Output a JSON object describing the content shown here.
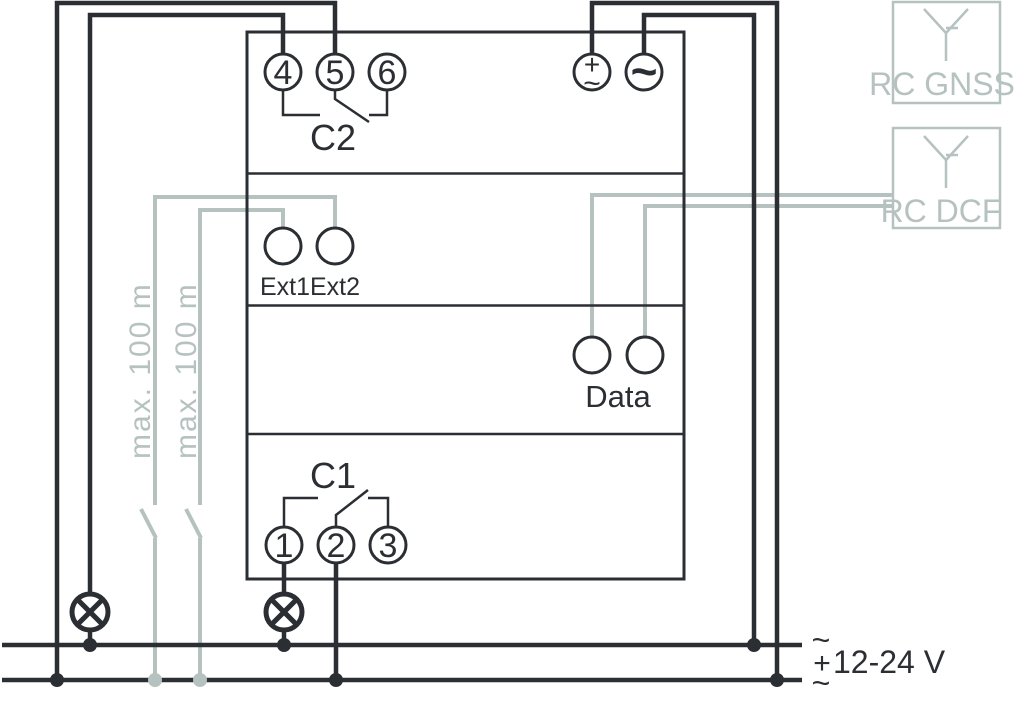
{
  "colors": {
    "wire_dark": "#2b2e33",
    "wire_gray": "#b6c2c0",
    "background": "#ffffff"
  },
  "device": {
    "relay_c2": {
      "label": "C2",
      "terminals": [
        "4",
        "5",
        "6"
      ]
    },
    "relay_c1": {
      "label": "C1",
      "terminals": [
        "1",
        "2",
        "3"
      ]
    },
    "ext_inputs": {
      "label": "Ext1Ext2"
    },
    "data_outputs": {
      "label": "Data"
    },
    "power_input": {
      "plus": "+",
      "tilde_small": "~",
      "tilde_bold": "~"
    }
  },
  "antennas": {
    "gnss": {
      "label": "RC GNSS"
    },
    "dcf": {
      "label": "RC DCF"
    }
  },
  "cable_notes": {
    "ext1": "max. 100 m",
    "ext2": "max. 100 m"
  },
  "power_supply": {
    "voltage": "12-24 V",
    "rail_top_symbol": "~",
    "rail_bottom_plus": "+",
    "rail_bottom_tilde": "~"
  }
}
